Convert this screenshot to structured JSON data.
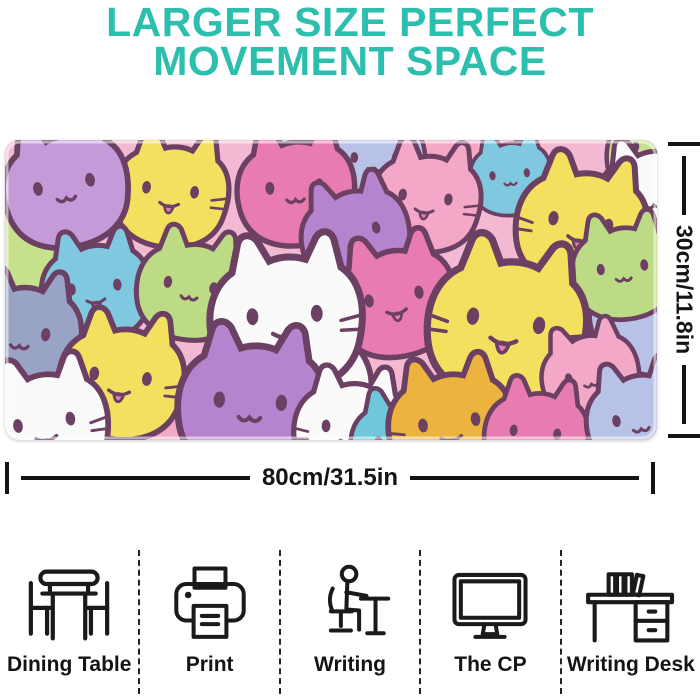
{
  "header": {
    "title_line1": "LARGER SIZE PERFECT",
    "title_line2": "MOVEMENT SPACE",
    "accent_color": "#2cbfad"
  },
  "product": {
    "name": "large cat-pattern gaming mouse pad",
    "width_label": "80cm/31.5in",
    "height_label": "30cm/11.8in",
    "pattern": {
      "description": "overlapping pastel cartoon cats with plum outlines",
      "outline_color": "#6b4063",
      "tongue_color": "#e87cb0",
      "background_color": "#f3b9d3",
      "palette": [
        "#c49ad8",
        "#f4e05e",
        "#f2a8c6",
        "#e87cb0",
        "#bcdb84",
        "#7fc8df",
        "#b8c1e6",
        "#fbfafa",
        "#98a3c6",
        "#ecb33f",
        "#b684ce",
        "#c6e08c",
        "#6fc8d9",
        "#f3b9d3"
      ]
    }
  },
  "dimension_color": "#141414",
  "features": [
    {
      "label": "Dining Table",
      "icon": "dining-table-icon"
    },
    {
      "label": "Print",
      "icon": "print-icon"
    },
    {
      "label": "Writing",
      "icon": "writing-icon"
    },
    {
      "label": "The CP",
      "icon": "the-cp-icon"
    },
    {
      "label": "Writing Desk",
      "icon": "writing-desk-icon"
    }
  ]
}
